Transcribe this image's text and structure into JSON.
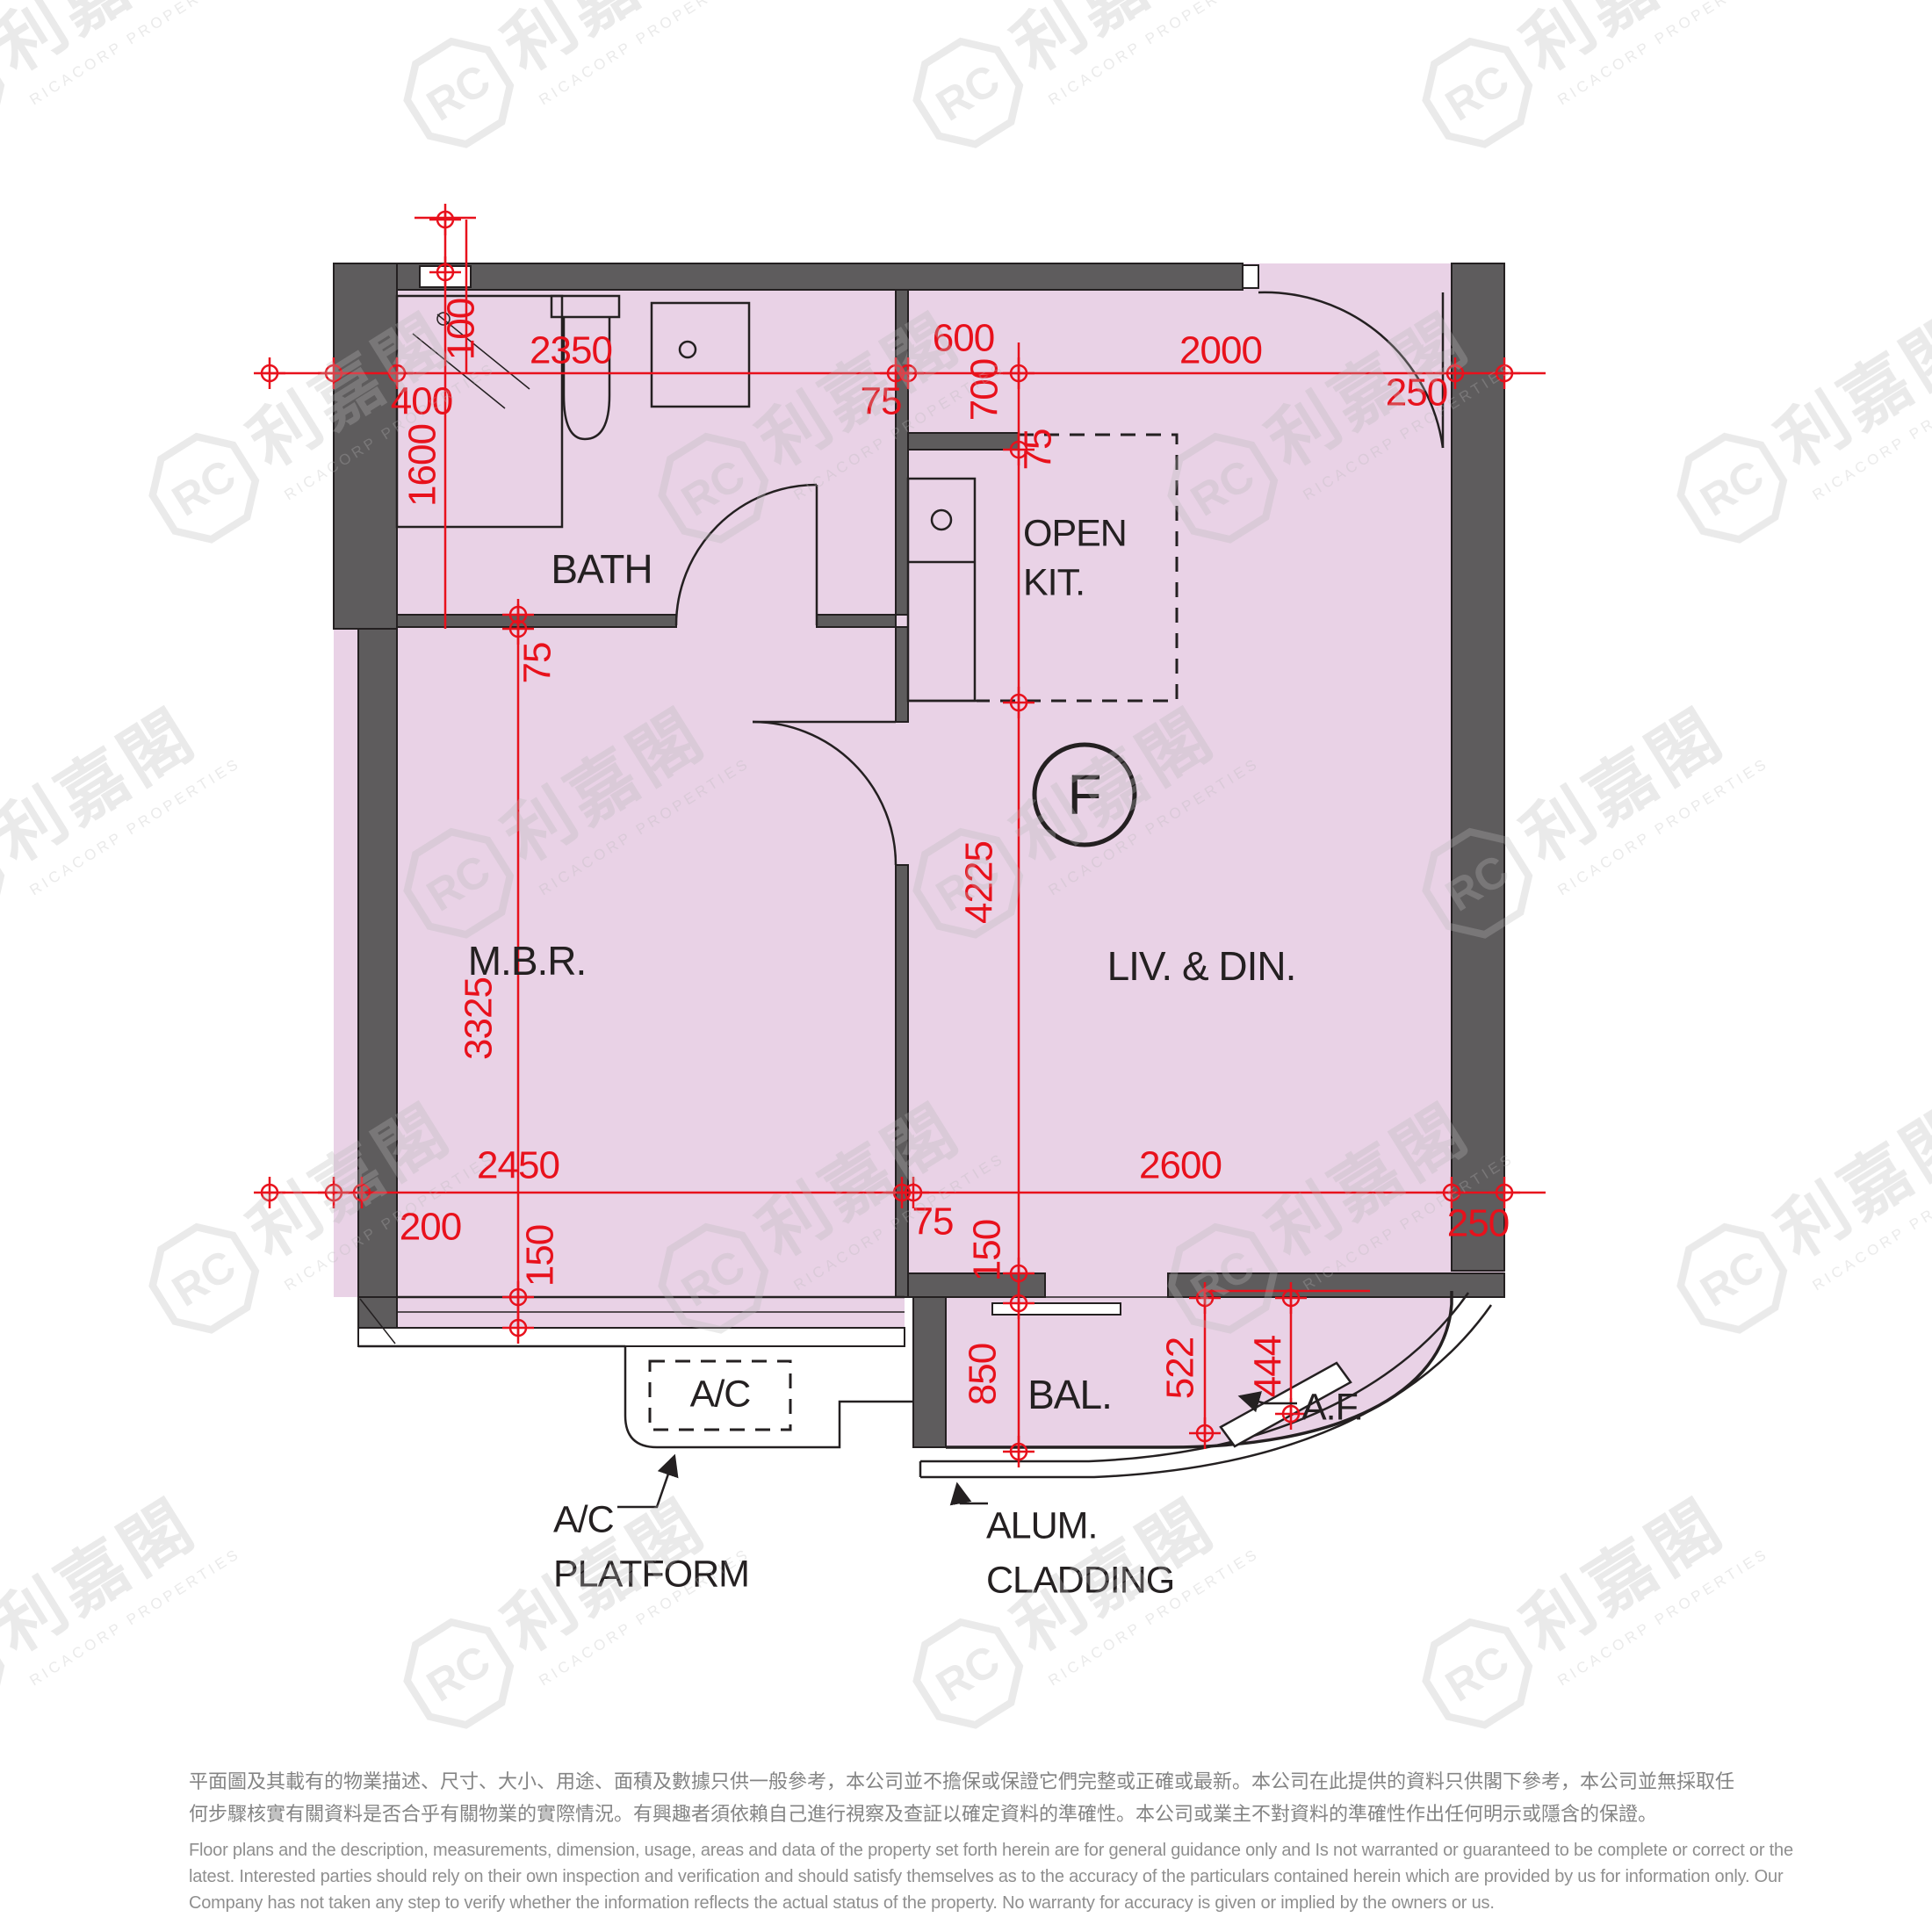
{
  "unit_label": "F",
  "rooms": {
    "bath": "BATH",
    "open_kit_line1": "OPEN",
    "open_kit_line2": "KIT.",
    "mbr": "M.B.R.",
    "living": "LIV. & DIN.",
    "balcony": "BAL.",
    "ac_unit": "A/C",
    "ac_platform_line1": "A/C",
    "ac_platform_line2": "PLATFORM",
    "alum_line1": "ALUM.",
    "alum_line2": "CLADDING",
    "af": "A.F."
  },
  "dims": {
    "d400": "400",
    "d100": "100",
    "d2350": "2350",
    "d75_top": "75",
    "d600": "600",
    "d700": "700",
    "d2000": "2000",
    "d250_top": "250",
    "d1600": "1600",
    "d75_kit": "75",
    "d75_bathwall": "75",
    "d3325": "3325",
    "d4225": "4225",
    "d2450": "2450",
    "d200": "200",
    "d150_left": "150",
    "d75_bottom": "75",
    "d2600": "2600",
    "d150_right": "150",
    "d250_bottom": "250",
    "d850": "850",
    "d522": "522",
    "d444": "444"
  },
  "watermark": {
    "logo_monogram": "RC",
    "logo_text": "利嘉閣",
    "subtext": "RICACORP PROPERTIES"
  },
  "disclaimer": {
    "zh_line1": "平面圖及其載有的物業描述、尺寸、大小、用途、面積及數據只供一般參考，本公司並不擔保或保證它們完整或正確或最新。本公司在此提供的資料只供閣下參考，本公司並無採取任",
    "zh_line2": "何步驟核實有關資料是否合乎有關物業的實際情況。有興趣者須依賴自己進行視察及查証以確定資料的準確性。本公司或業主不對資料的準確性作出任何明示或隱含的保證。",
    "en_line1": "Floor plans and the description, measurements, dimension, usage, areas and data of the property set forth herein are for general guidance only and Is not warranted or guaranteed to be complete or correct or the",
    "en_line2": "latest. Interested parties should rely on their own inspection and verification and should satisfy themselves as to the accuracy of the particulars contained herein which are provided by us for information only.  Our",
    "en_line3": "Company has not taken any step to verify whether the information reflects the actual status of the property.  No warranty for accuracy is given or implied by the owners or us."
  },
  "colors": {
    "room_fill": "#e9d2e6",
    "wall_gray": "#5e5c5d",
    "dimension_red": "#e8111c",
    "line_black": "#242021",
    "disclaimer_gray": "#8a8a8a",
    "watermark_gray": "#bfbfbf"
  }
}
